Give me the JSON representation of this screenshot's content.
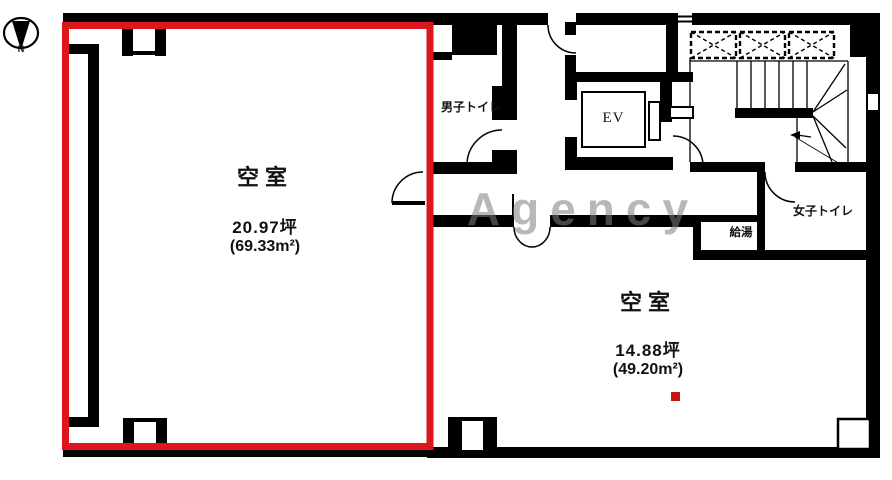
{
  "compass": {
    "north_label": "N"
  },
  "left_room": {
    "label": "空室",
    "area_tsubo": "20.97坪",
    "area_m2": "(69.33m²)"
  },
  "right_room": {
    "label": "空室",
    "area_tsubo": "14.88坪",
    "area_m2": "(49.20m²)"
  },
  "facilities": {
    "mens_toilet": "男子トイレ",
    "womens_toilet": "女子トイレ",
    "hot_water": "給湯",
    "elevator": "EV"
  },
  "watermark": "Agency",
  "colors": {
    "red_outline": "#dc161c",
    "marker_red": "#cc1111",
    "wall_black": "#000000"
  }
}
